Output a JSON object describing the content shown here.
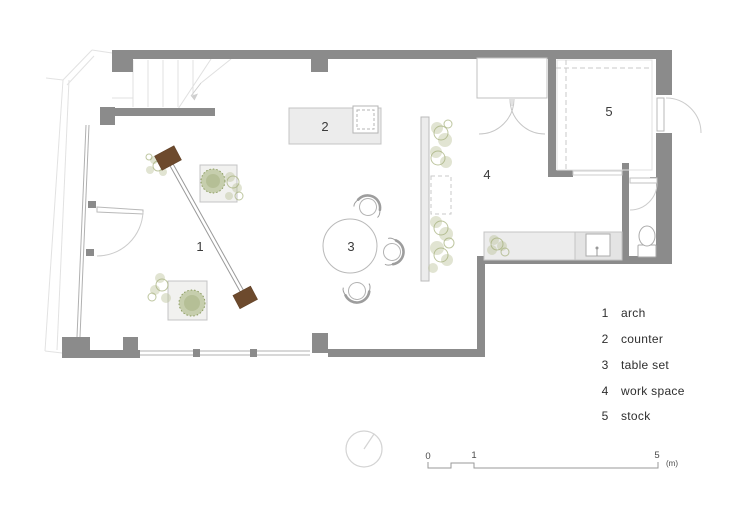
{
  "drawing": {
    "type": "architectural floor plan",
    "areas": [
      {
        "number": "1",
        "label": "arch"
      },
      {
        "number": "2",
        "label": "counter"
      },
      {
        "number": "3",
        "label": "table set"
      },
      {
        "number": "4",
        "label": "work space"
      },
      {
        "number": "5",
        "label": "stock"
      }
    ],
    "scale_bar": {
      "ticks": [
        "0",
        "1",
        "5"
      ],
      "unit": "(m)"
    },
    "colors": {
      "wall": "#8b8b8b",
      "furniture_fill": "#ececec",
      "furniture_outline": "#c4c4c4",
      "glass_line": "#b0b0b0",
      "light_line": "#e2e2e2",
      "plant_stroke": "#a3ae78",
      "plant_fill": "#bcc49b",
      "tree_fill": "#a3b176",
      "wood": "#6d4a2d",
      "label_text": "#3b3b3b"
    }
  }
}
